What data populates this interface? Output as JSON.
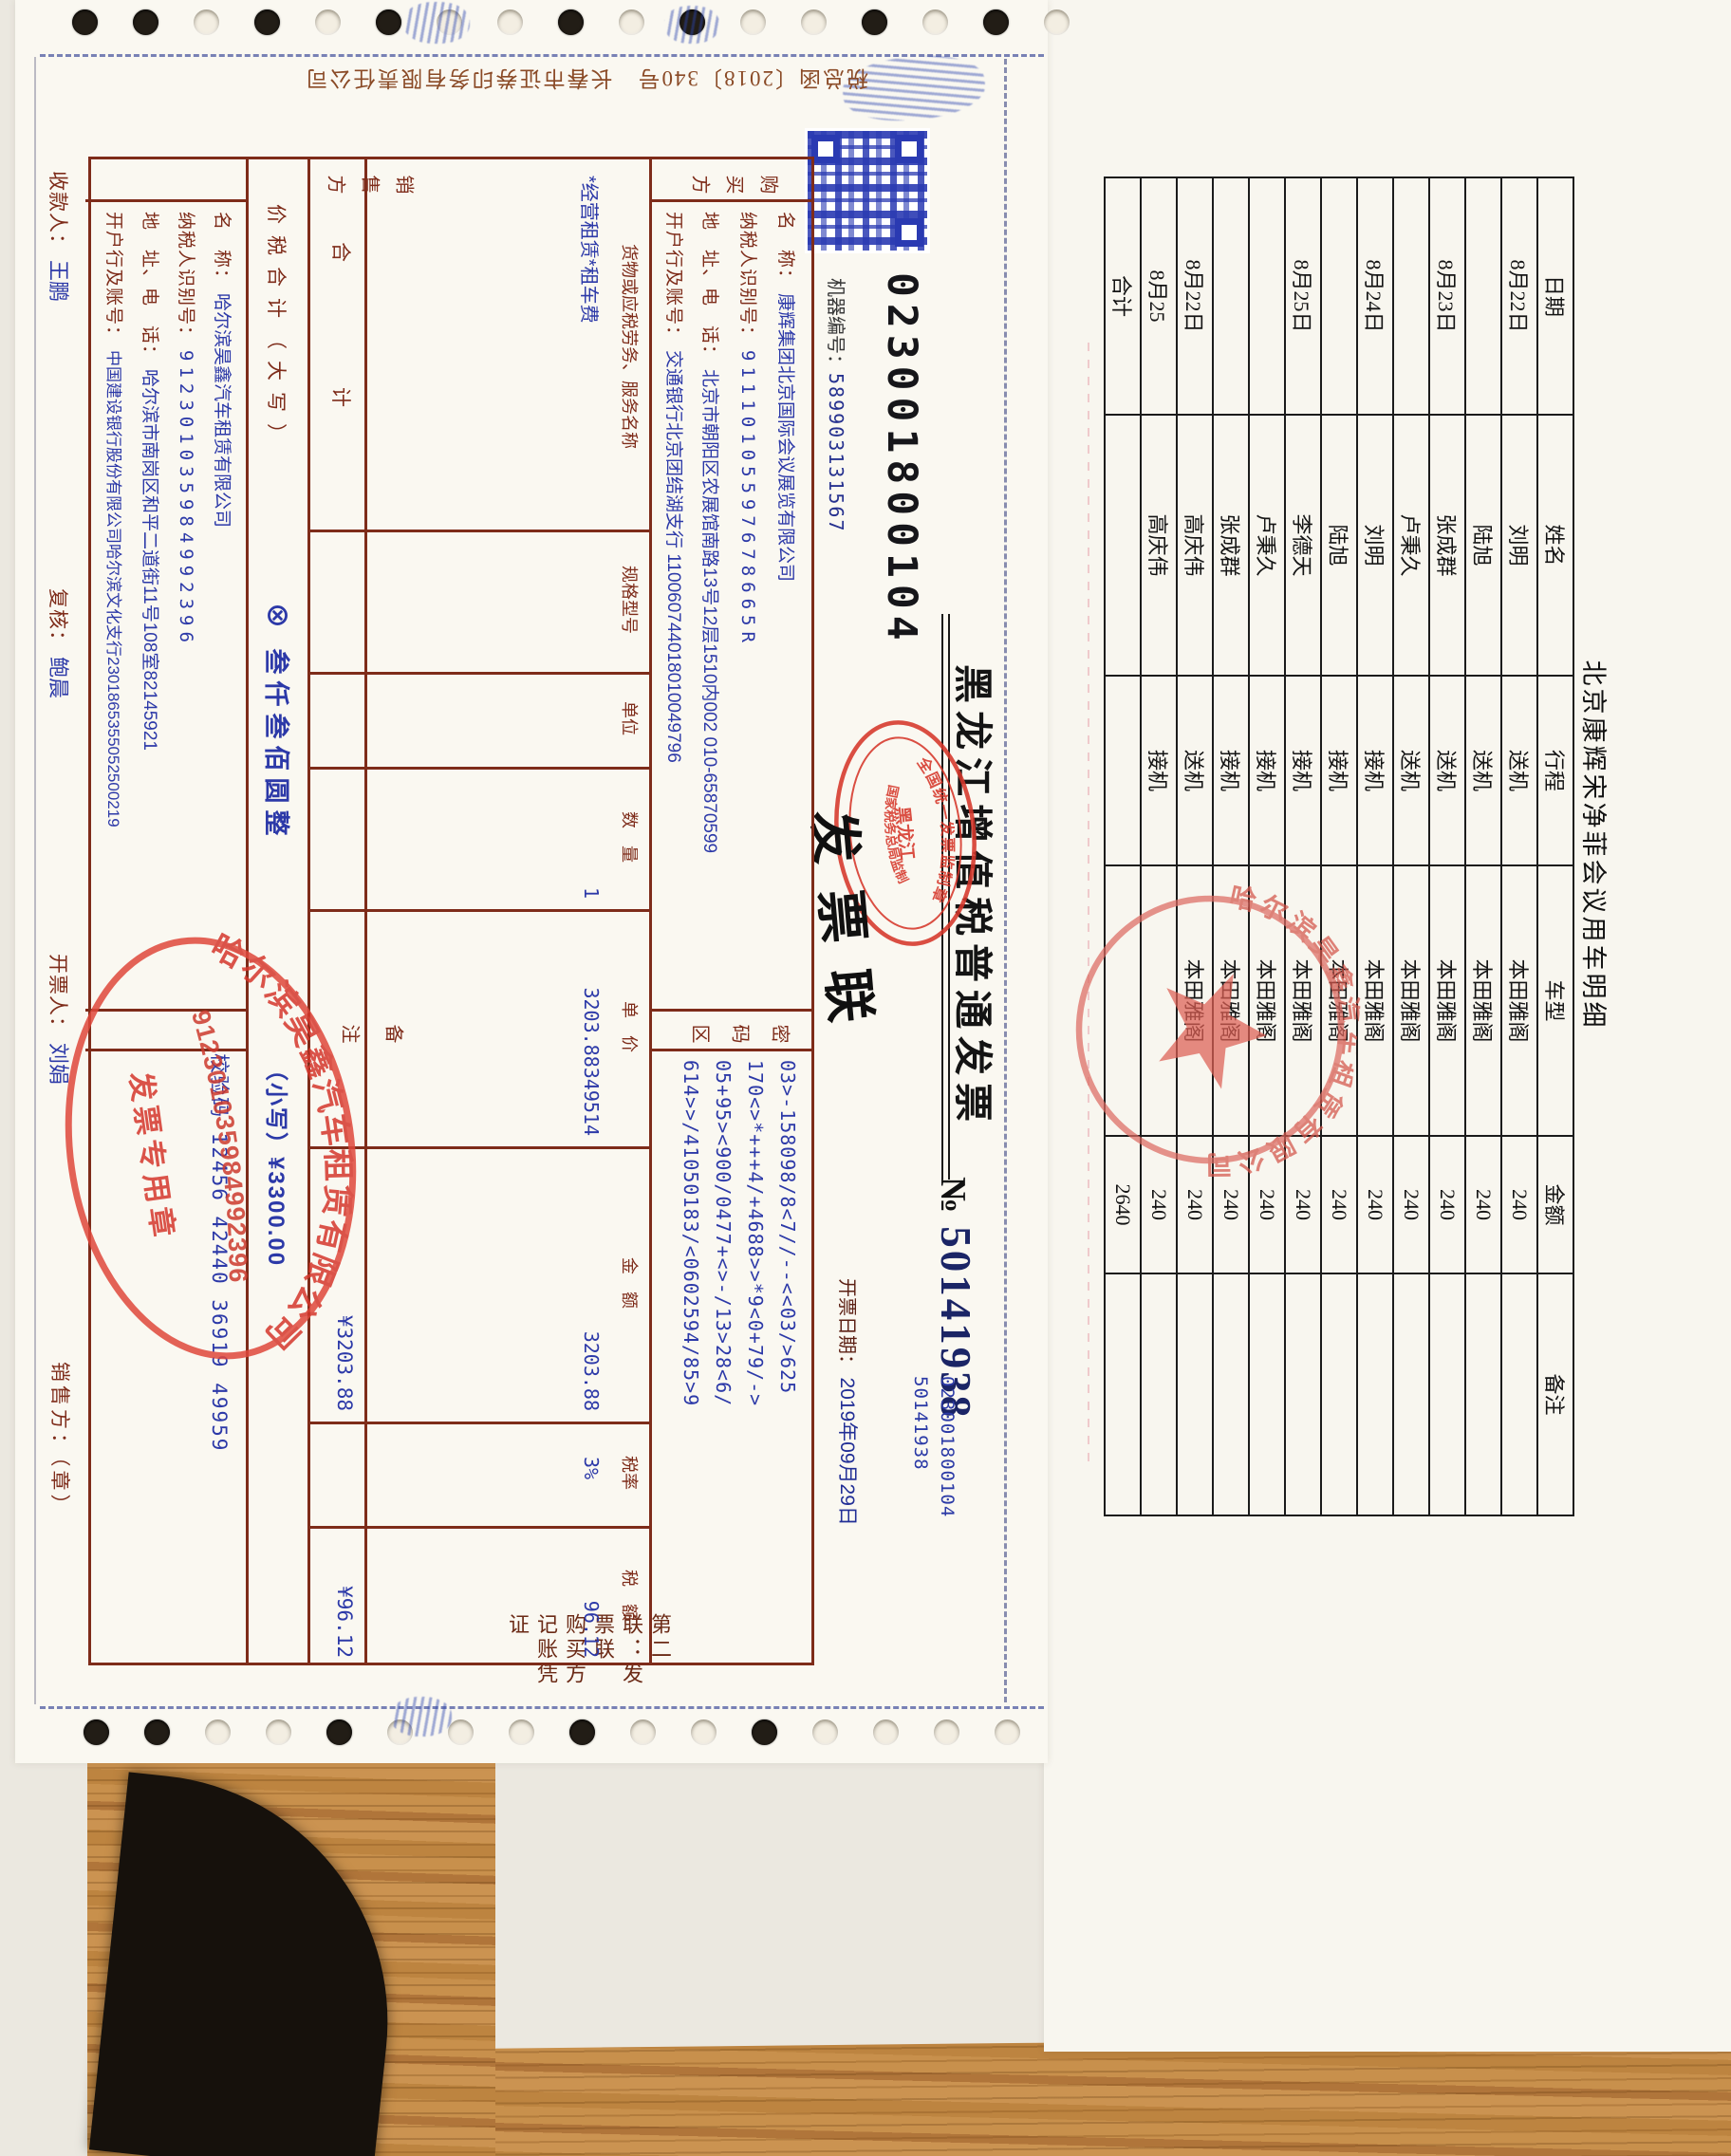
{
  "invoice": {
    "code_top": "023001800104",
    "machine_label": "机器编号：",
    "machine_no": "589903131567",
    "title": "黑龙江增值税普通发票",
    "no_symbol": "№",
    "no_value": "50141938",
    "side_codes": [
      "023001800104",
      "50141938"
    ],
    "date_label": "开票日期：",
    "date_value": "2019年09月29日",
    "overprint": "发票联",
    "copy_note": "第二联：发票联　购买方记账凭证",
    "printer_note": "税总函〔2018〕340号　长春市证券印务有限责任公司",
    "supervision_stamp": {
      "arc_top": "全国统一发票监制章",
      "center": "黑龙江",
      "arc_bottom": "国家税务总局监制"
    },
    "buyer": {
      "side_label": "购买方",
      "name_label": "名　称：",
      "name": "康辉集团北京国际会议展览有限公司",
      "tax_id_label": "纳税人识别号：",
      "tax_id": "91110105597678665R",
      "addr_label": "地　址、电　话：",
      "addr": "北京市朝阳区农展馆南路13号12层1510内002 010-65870599",
      "bank_label": "开户行及账号：",
      "bank": "交通银行北京团结湖支行 110060744018010049796"
    },
    "password": {
      "side_label": "密码区",
      "lines": [
        "03>-158098/8<7//--<<03/>625",
        "170<>*+++4/+4688>>*9<0+79/->",
        "05+95><900/0477+<>-/13>28<6/",
        "614>>/41050183/<0602594/85>9"
      ]
    },
    "items": {
      "headers": {
        "name": "货物或应税劳务、服务名称",
        "spec": "规格型号",
        "unit": "单位",
        "qty": "数　量",
        "price": "单　价",
        "amount": "金　额",
        "rate": "税率",
        "tax": "税　额"
      },
      "row": {
        "name": "*经营租赁*租车费",
        "qty": "1",
        "price": "3203.88349514",
        "amount": "3203.88",
        "rate": "3%",
        "tax": "96.12"
      }
    },
    "total_row": {
      "label": "合　　计",
      "amount": "¥3203.88",
      "tax": "¥96.12"
    },
    "grand_row": {
      "label": "价税合计（大写）",
      "capital": "⊗ 叁仟叁佰圆整",
      "small": "（小写）¥3300.00"
    },
    "seller": {
      "side_label": "销售方",
      "name_label": "名　称：",
      "name": "哈尔滨昊鑫汽车租赁有限公司",
      "tax_id_label": "纳税人识别号：",
      "tax_id": "912301035984992396",
      "addr_label": "地　址、电　话：",
      "addr": "哈尔滨市南岗区和平二道街11号108室82145921",
      "bank_label": "开户行及账号：",
      "bank": "中国建设银行股份有限公司哈尔滨文化支行2301865355052500219"
    },
    "remarks": {
      "side_label": "备注",
      "check_code": "校验码 12456 42440 36919 49959"
    },
    "footer": {
      "payee_label": "收款人：",
      "payee": "王鹏",
      "review_label": "复核：",
      "reviewer": "鲍晨",
      "drawer_label": "开票人：",
      "drawer": "刘娟",
      "seller_sign_label": "销售方：（章）"
    },
    "seller_stamp": {
      "company": "哈尔滨昊鑫汽车租赁有限公司",
      "tax_id": "912301035984992396",
      "caption": "发票专用章"
    }
  },
  "schedule": {
    "title": "北京康辉宋净菲会议用车明细",
    "headers": [
      "日期",
      "姓名",
      "行程",
      "车型",
      "金额",
      "备注"
    ],
    "rows": [
      [
        "8月22日",
        "刘明",
        "送机",
        "本田雅阁",
        "240",
        ""
      ],
      [
        "",
        "陆旭",
        "送机",
        "本田雅阁",
        "240",
        ""
      ],
      [
        "8月23日",
        "张成群",
        "送机",
        "本田雅阁",
        "240",
        ""
      ],
      [
        "",
        "卢秉久",
        "送机",
        "本田雅阁",
        "240",
        ""
      ],
      [
        "8月24日",
        "刘明",
        "接机",
        "本田雅阁",
        "240",
        ""
      ],
      [
        "",
        "陆旭",
        "接机",
        "本田雅阁",
        "240",
        ""
      ],
      [
        "8月25日",
        "李德天",
        "接机",
        "本田雅阁",
        "240",
        ""
      ],
      [
        "",
        "卢秉久",
        "接机",
        "本田雅阁",
        "240",
        ""
      ],
      [
        "",
        "张成群",
        "接机",
        "本田雅阁",
        "240",
        ""
      ],
      [
        "8月22日",
        "高庆伟",
        "送机",
        "本田雅阁",
        "240",
        ""
      ],
      [
        "8月25",
        "高庆伟",
        "接机",
        "",
        "240",
        ""
      ],
      [
        "合计",
        "",
        "",
        "",
        "2640",
        ""
      ]
    ],
    "stamp_company": "哈尔滨昊鑫汽车租赁有限公司"
  },
  "colors": {
    "grid_red": "#7e2c1a",
    "value_blue": "#2c39a8",
    "stamp_red": "#d6372b",
    "number_navy": "#1b2566"
  }
}
